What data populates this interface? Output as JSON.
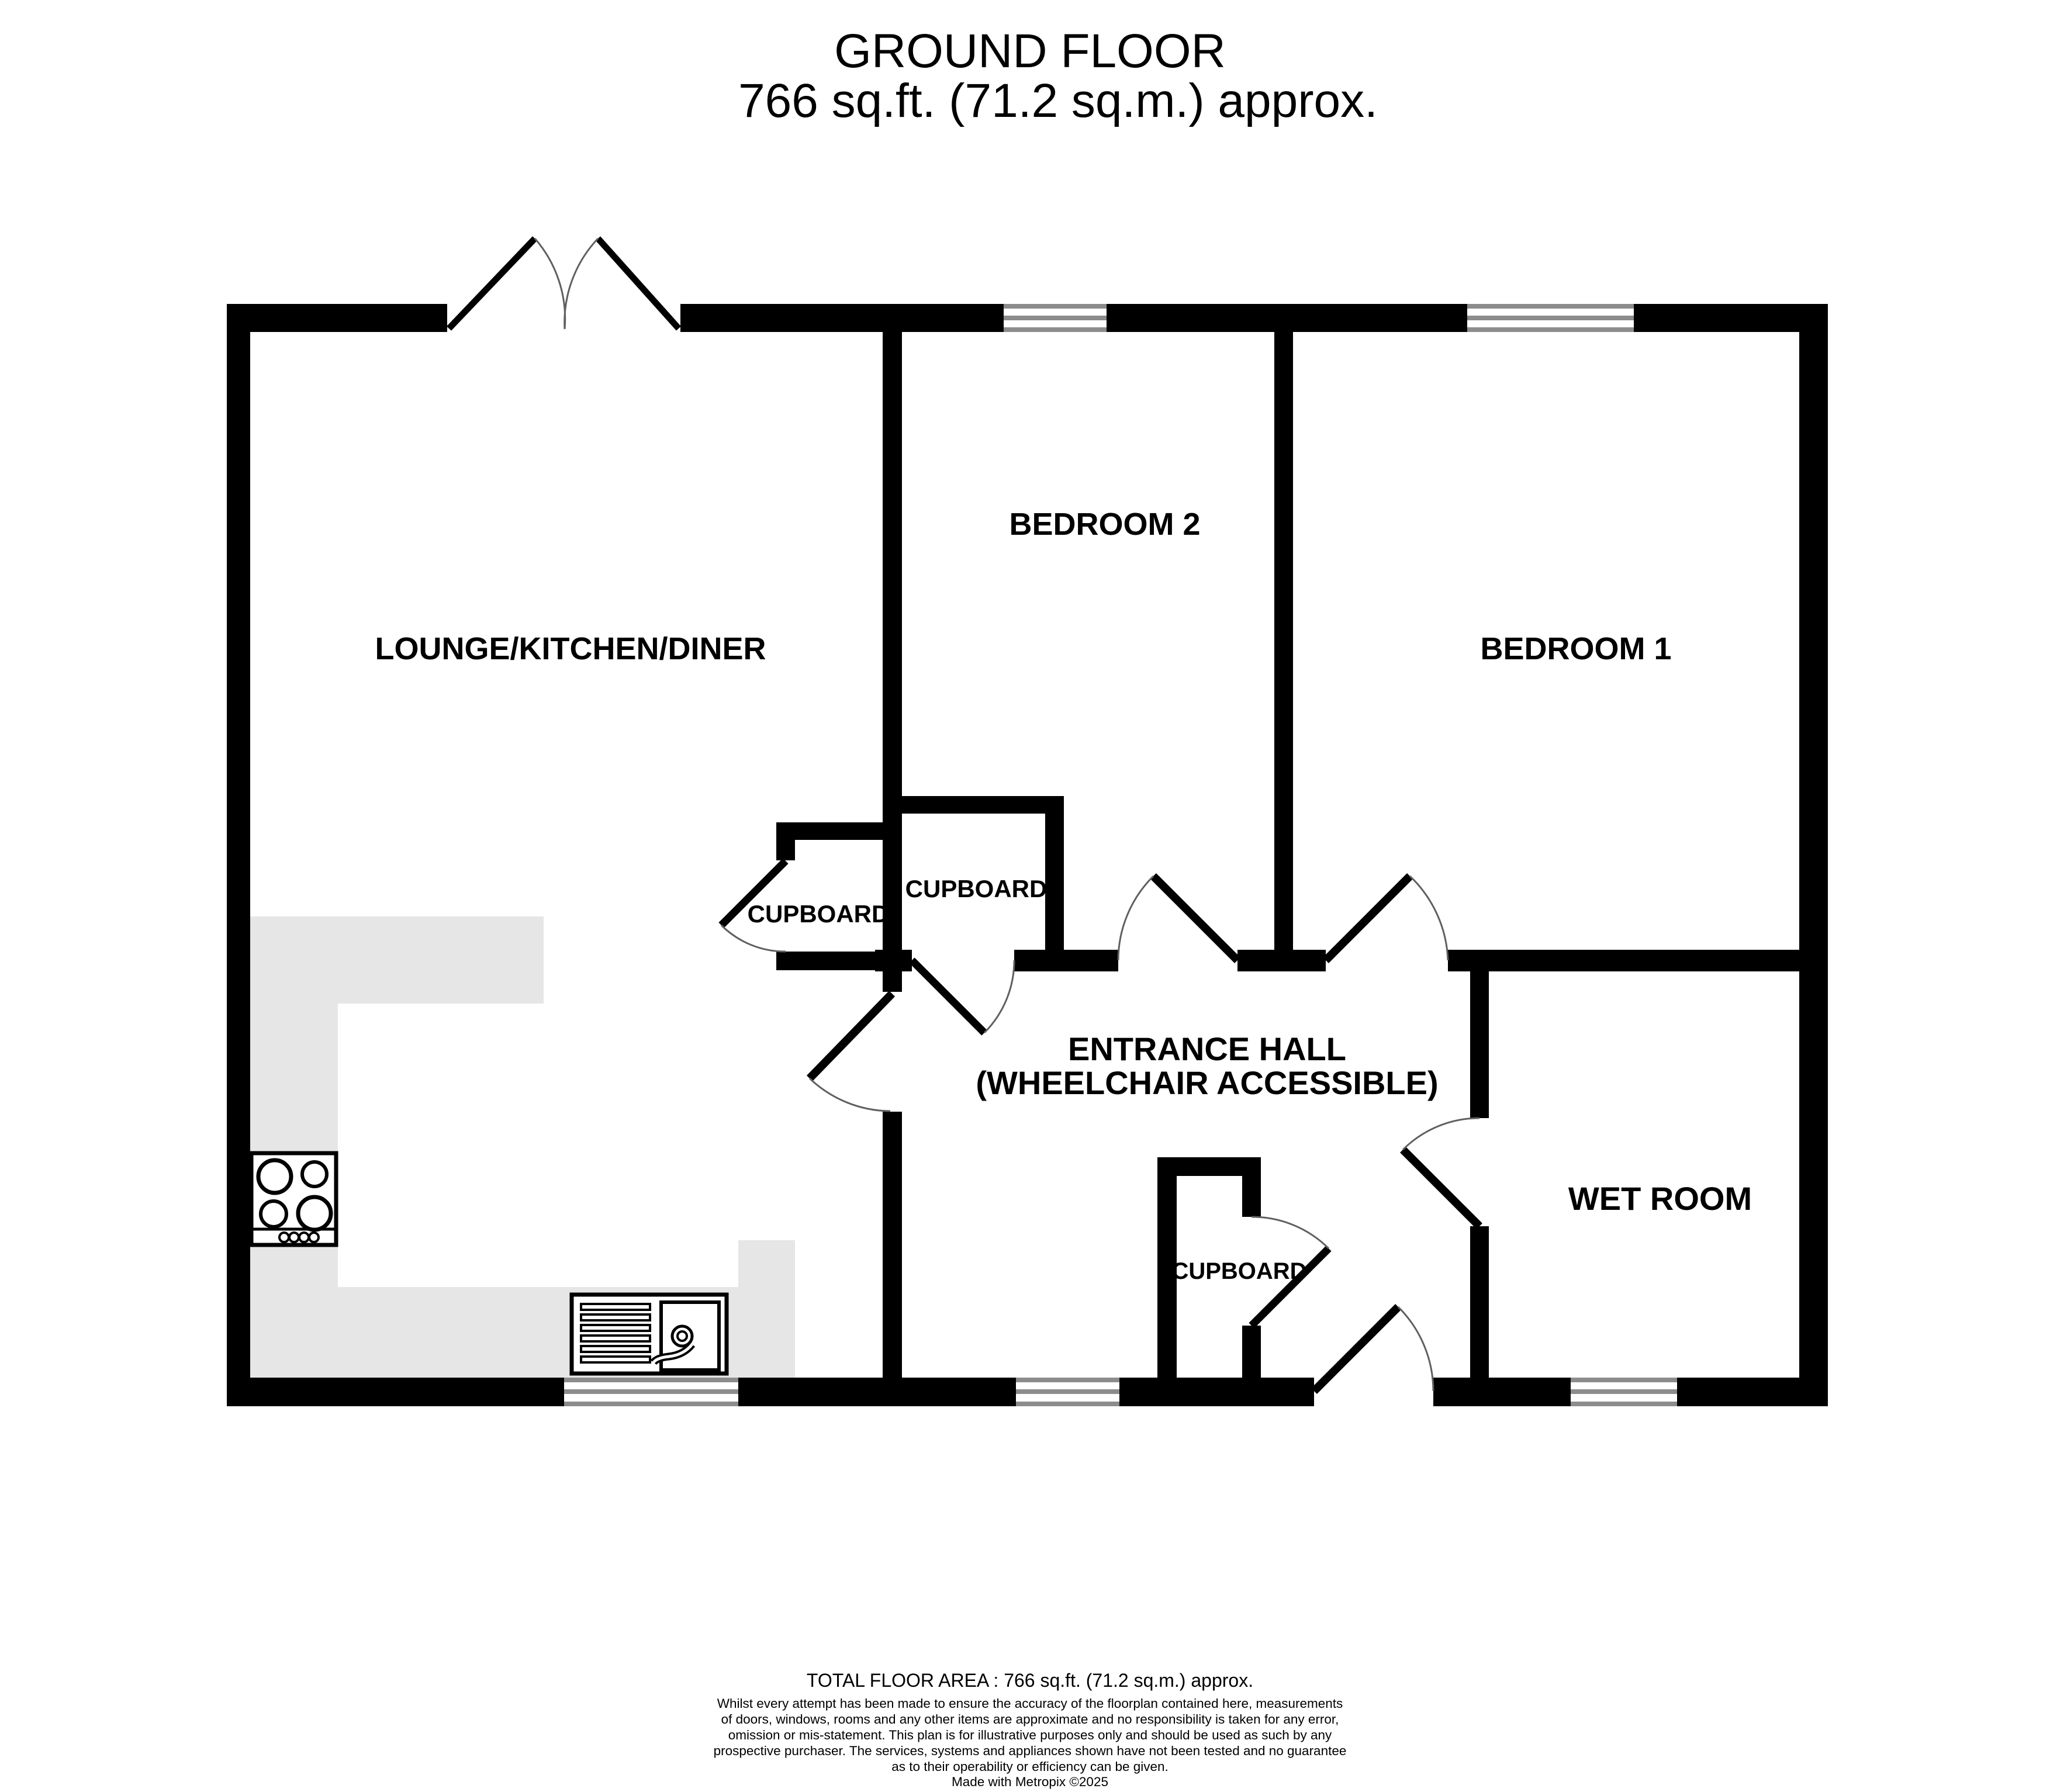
{
  "title": {
    "line1": "GROUND FLOOR",
    "line2": "766 sq.ft. (71.2 sq.m.) approx."
  },
  "rooms": {
    "lounge": "LOUNGE/KITCHEN/DINER",
    "bedroom2": "BEDROOM 2",
    "bedroom1": "BEDROOM 1",
    "cupboard_left": "CUPBOARD",
    "cupboard_center": "CUPBOARD",
    "cupboard_bottom": "CUPBOARD",
    "entrance_hall_line1": "ENTRANCE HALL",
    "entrance_hall_line2": "(WHEELCHAIR ACCESSIBLE)",
    "wet_room": "WET ROOM"
  },
  "footer": {
    "total_area": "TOTAL FLOOR AREA : 766 sq.ft. (71.2 sq.m.) approx.",
    "disclaimer": [
      "Whilst every attempt has been made to ensure the accuracy of the floorplan contained here, measurements",
      "of doors, windows, rooms and any other items are approximate and no responsibility is taken for any error,",
      "omission or mis-statement. This plan is for illustrative purposes only and should be used as such by any",
      "prospective purchaser. The services, systems and appliances shown have not been tested and no guarantee",
      "as to their operability or efficiency can be given."
    ],
    "credit": "Made with Metropix ©2025"
  },
  "colors": {
    "wall": "#000000",
    "counter": "#e6e6e6",
    "window_frame": "#8c8c8c",
    "door_arc": "#606060",
    "text": "#000000",
    "background": "#ffffff"
  }
}
